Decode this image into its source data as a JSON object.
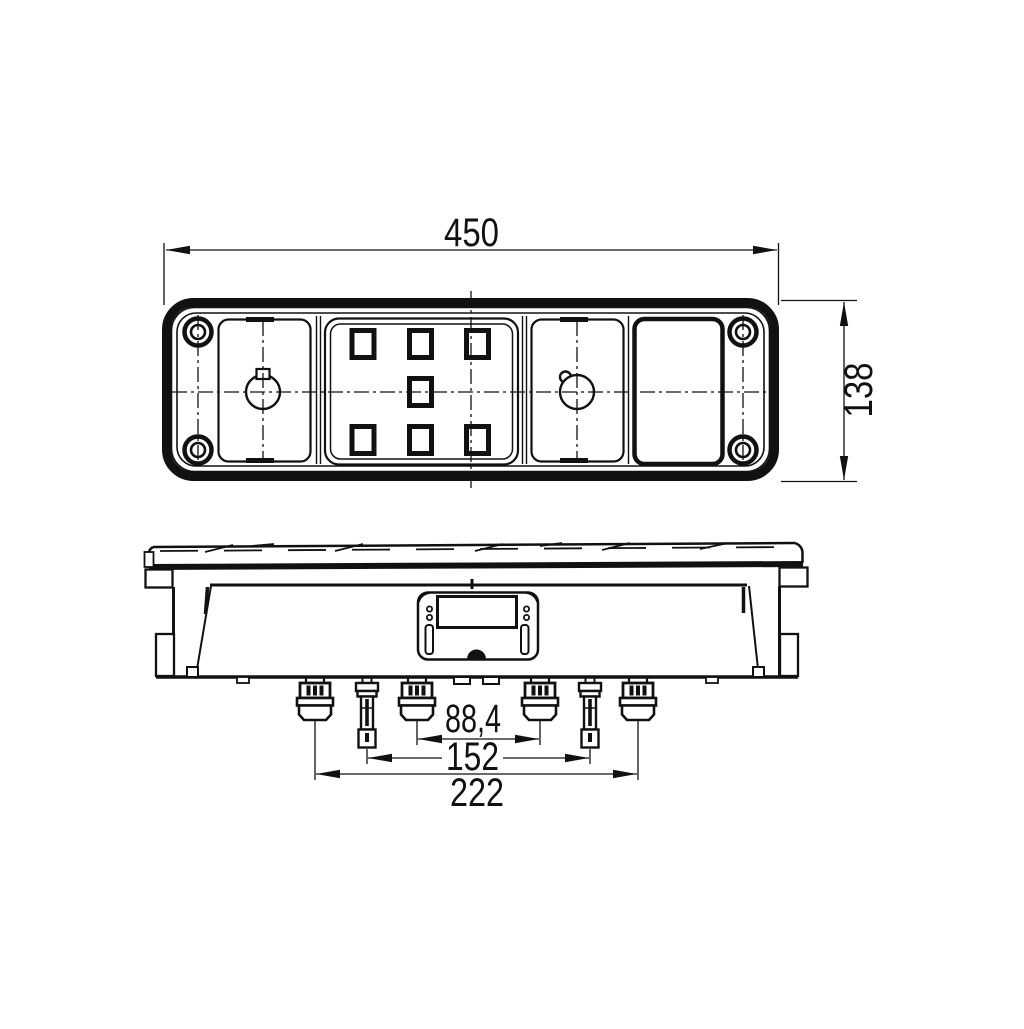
{
  "colors": {
    "line": "#111111",
    "background": "#ffffff"
  },
  "dimensions": {
    "overall_width": {
      "label": "450"
    },
    "overall_height": {
      "label": "138"
    },
    "connector_spacing_inner": {
      "label": "88,4"
    },
    "connector_spacing_middle": {
      "label": "152"
    },
    "connector_spacing_outer": {
      "label": "222"
    }
  }
}
